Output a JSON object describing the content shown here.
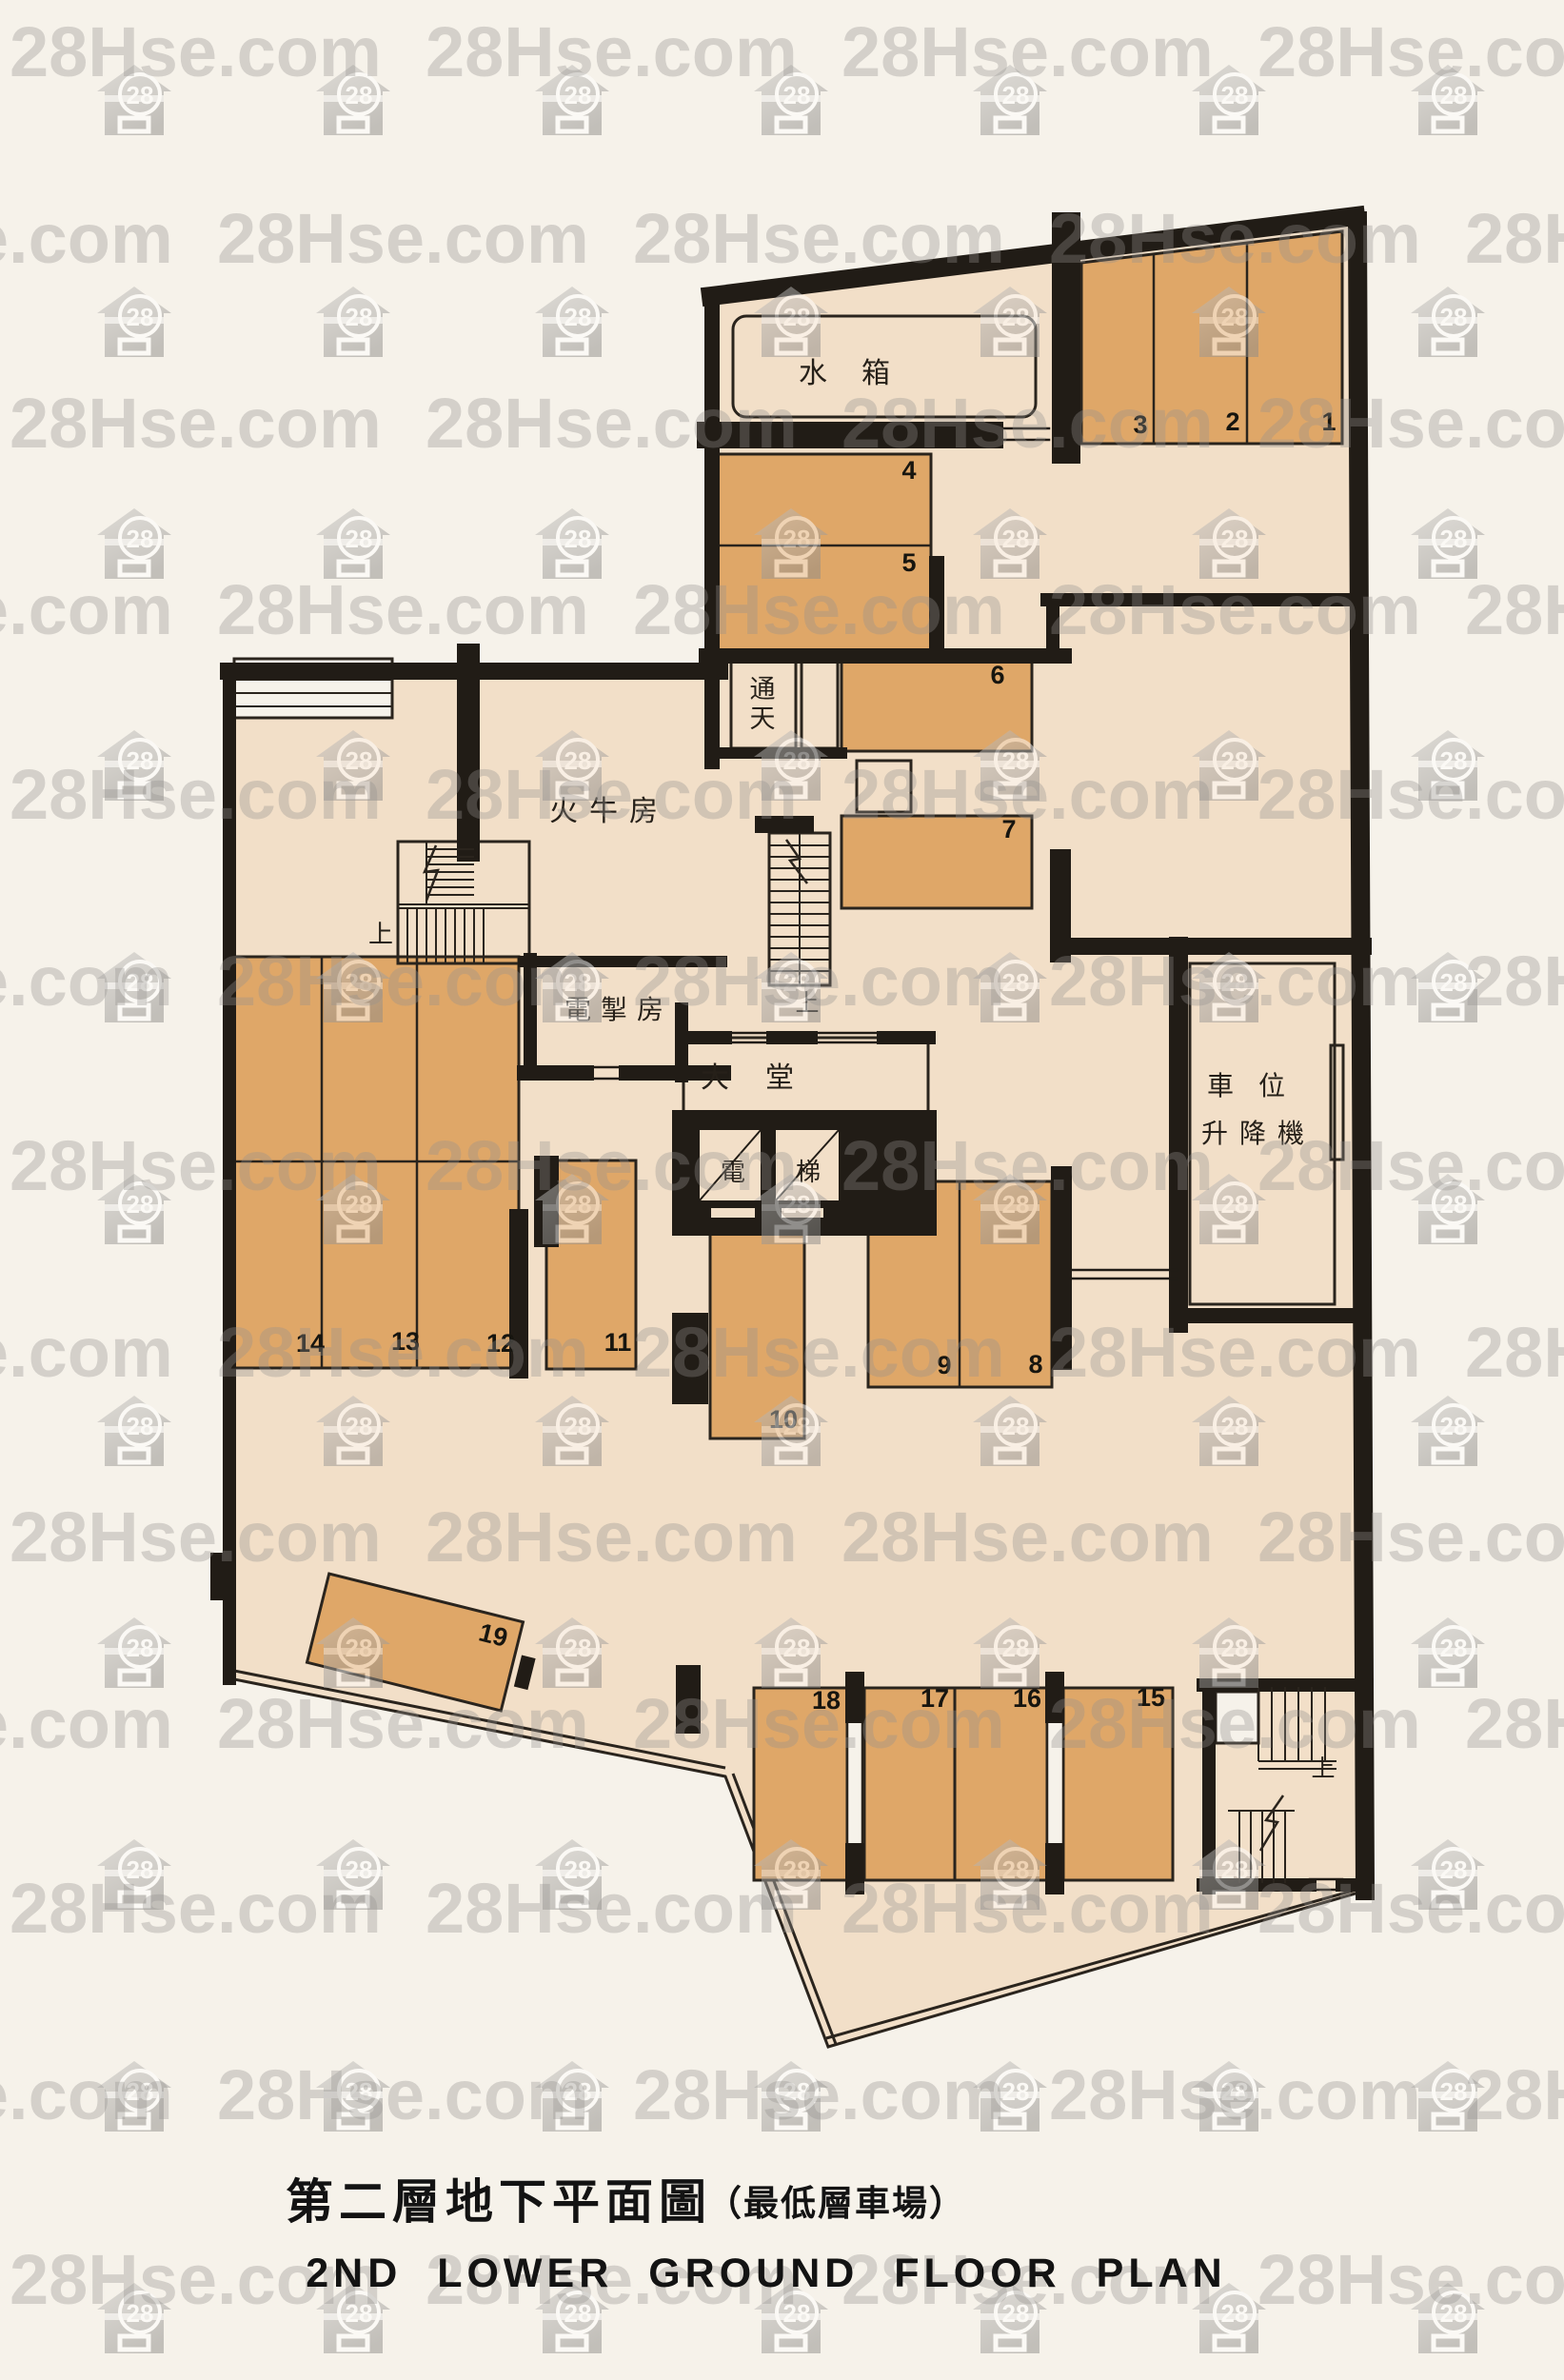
{
  "watermark": {
    "brand": "28Hse.com",
    "badge": "28"
  },
  "plan": {
    "rooms": {
      "water_tank": "水箱",
      "light_well": "通天",
      "transformer_room": "火牛房",
      "switch_room": "電掣房",
      "lobby": "大堂",
      "lift_car_left": "電",
      "lift_car_right": "梯",
      "car_lift_line1": "車位",
      "car_lift_line2": "升降機",
      "stairs_up": "上"
    },
    "parking_spaces": [
      "1",
      "2",
      "3",
      "4",
      "5",
      "6",
      "7",
      "8",
      "9",
      "10",
      "11",
      "12",
      "13",
      "14",
      "15",
      "16",
      "17",
      "18",
      "19"
    ]
  },
  "titles": {
    "chinese_main": "第二層地下平面圖",
    "chinese_sub": "（最低層車場）",
    "english": "2ND LOWER GROUND FLOOR PLAN"
  }
}
